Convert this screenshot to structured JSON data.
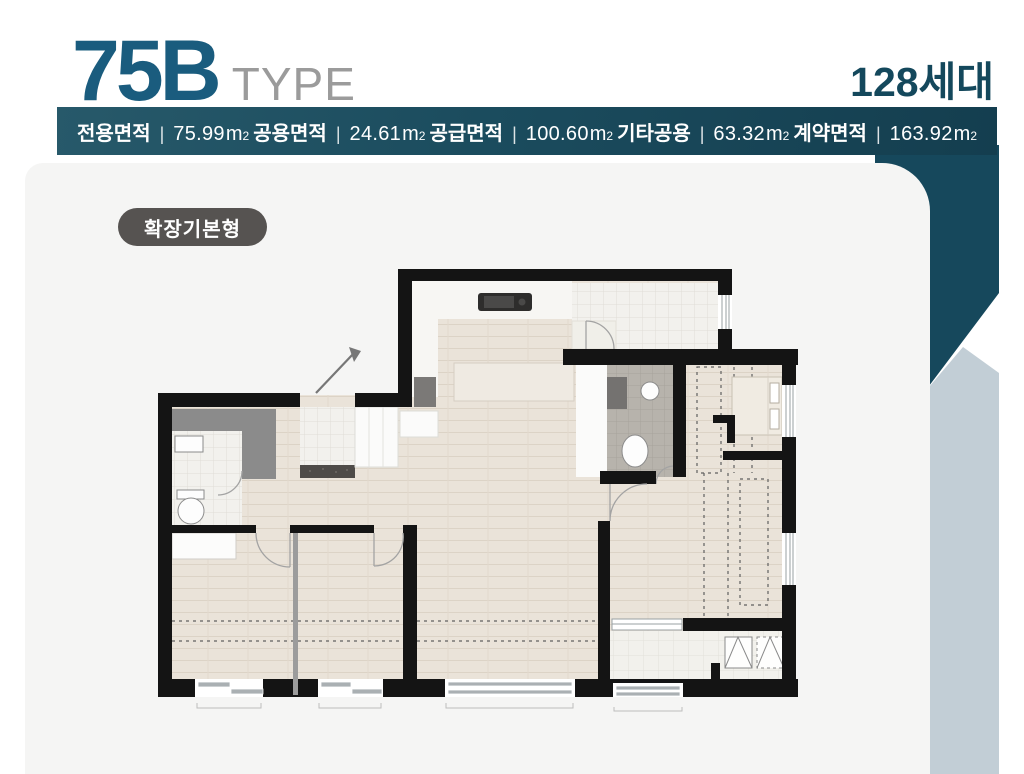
{
  "header": {
    "unit_type": "75B",
    "type_suffix": "TYPE",
    "household_count": "128세대",
    "separator": "|",
    "area_unit": "m",
    "area_sup": "2",
    "specs": [
      {
        "label": "전용면적",
        "value": "75.99"
      },
      {
        "label": "공용면적",
        "value": "24.61"
      },
      {
        "label": "공급면적",
        "value": "100.60"
      },
      {
        "label": "기타공용",
        "value": "63.32"
      },
      {
        "label": "계약면적",
        "value": "163.92"
      }
    ]
  },
  "plan": {
    "variant_badge": "확장기본형"
  },
  "colors": {
    "title_accent": "#1a5c7e",
    "type_gray": "#9b9b9b",
    "bar_teal": "#1b4c5e",
    "household_teal": "#14485c",
    "badge_gray": "#565351",
    "panel_gray": "#f5f5f4",
    "deco_teal": "#16485c",
    "deco_bluegray": "#c2ced6",
    "plan_wall": "#141414",
    "plan_wood": "#eae3d9"
  }
}
